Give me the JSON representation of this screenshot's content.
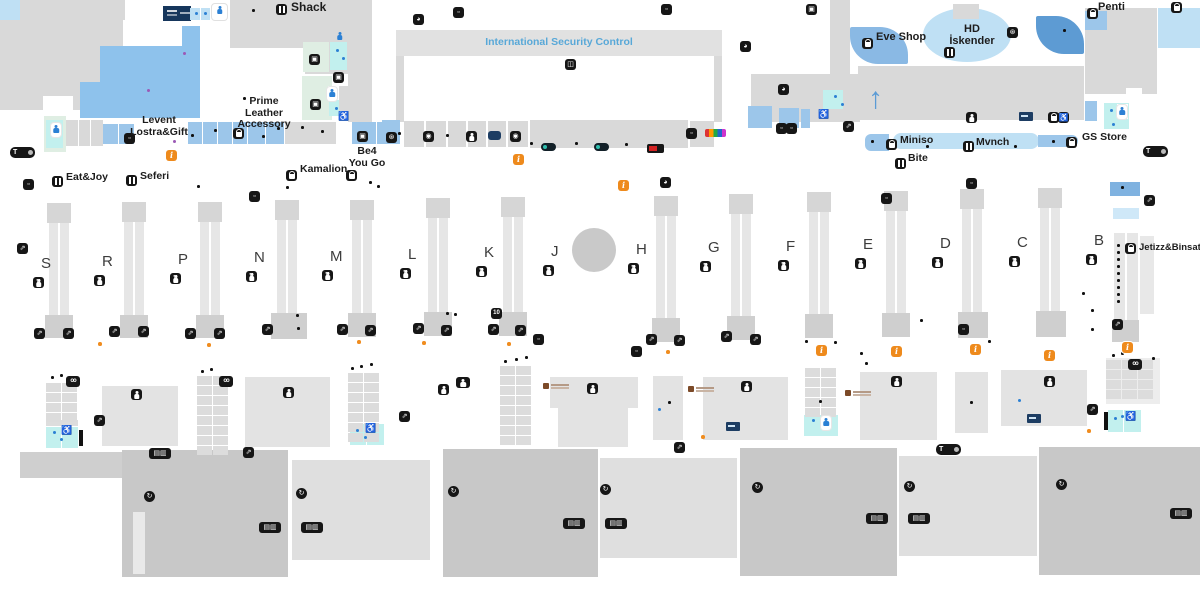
{
  "colors": {
    "accent_blue": "#58a8d8",
    "info_orange": "#ee8a1c",
    "teal_wc": "#c2f0ee",
    "navy": "#16365c",
    "map_gray": "#d9d9d9"
  },
  "labels": {
    "shack": "Shack",
    "security": "International Security Control",
    "eve_shop": "Eve Shop",
    "hd1": "HD",
    "hd2": "İskender",
    "penti": "Penti",
    "prime1": "Prime",
    "prime2": "Leather",
    "prime3": "Accessory",
    "levent1": "Levent",
    "levent2": "Lostra&Gift",
    "eat_joy": "Eat&Joy",
    "seferi": "Seferi",
    "kamalion": "Kamalion",
    "be41": "Be4",
    "be42": "You Go",
    "miniso": "Miniso",
    "mvnch": "Mvnch",
    "bite": "Bite",
    "gs_store": "GS Store",
    "jetizz": "Jetizz&Binsat"
  },
  "gates": [
    {
      "letter": "S",
      "x": 46,
      "y": 264
    },
    {
      "letter": "R",
      "x": 107,
      "y": 262
    },
    {
      "letter": "P",
      "x": 183,
      "y": 260
    },
    {
      "letter": "N",
      "x": 259,
      "y": 258
    },
    {
      "letter": "M",
      "x": 335,
      "y": 257
    },
    {
      "letter": "L",
      "x": 413,
      "y": 255
    },
    {
      "letter": "K",
      "x": 489,
      "y": 253
    },
    {
      "letter": "J",
      "x": 556,
      "y": 252
    },
    {
      "letter": "H",
      "x": 641,
      "y": 250
    },
    {
      "letter": "G",
      "x": 713,
      "y": 248
    },
    {
      "letter": "F",
      "x": 791,
      "y": 247
    },
    {
      "letter": "E",
      "x": 868,
      "y": 245
    },
    {
      "letter": "D",
      "x": 945,
      "y": 244
    },
    {
      "letter": "C",
      "x": 1022,
      "y": 243
    },
    {
      "letter": "B",
      "x": 1099,
      "y": 241
    }
  ],
  "markers": [
    {
      "t": "personbox",
      "x": 212,
      "y": 4
    },
    {
      "t": "food",
      "x": 276,
      "y": 4
    },
    {
      "t": "clock",
      "x": 413,
      "y": 14
    },
    {
      "t": "misc",
      "x": 453,
      "y": 7
    },
    {
      "t": "misc",
      "x": 661,
      "y": 4
    },
    {
      "t": "clock",
      "x": 740,
      "y": 41
    },
    {
      "t": "art",
      "x": 806,
      "y": 4
    },
    {
      "t": "clock",
      "x": 778,
      "y": 84
    },
    {
      "t": "wheel",
      "x": 1007,
      "y": 27
    },
    {
      "t": "bag",
      "x": 1087,
      "y": 8
    },
    {
      "t": "bag",
      "x": 1171,
      "y": 2
    },
    {
      "t": "bag",
      "x": 862,
      "y": 38
    },
    {
      "t": "food",
      "x": 944,
      "y": 47
    },
    {
      "t": "wc",
      "x": 966,
      "y": 112
    },
    {
      "t": "atm",
      "x": 1019,
      "y": 112
    },
    {
      "t": "bag",
      "x": 1048,
      "y": 112
    },
    {
      "t": "wheelchairk",
      "x": 1058,
      "y": 112
    },
    {
      "t": "personblue",
      "x": 1117,
      "y": 105
    },
    {
      "t": "pill",
      "x": 10,
      "y": 147
    },
    {
      "t": "pill",
      "x": 1143,
      "y": 146
    },
    {
      "t": "pill",
      "x": 936,
      "y": 444
    },
    {
      "t": "misc",
      "x": 124,
      "y": 133
    },
    {
      "t": "bag",
      "x": 233,
      "y": 128
    },
    {
      "t": "art",
      "x": 357,
      "y": 131
    },
    {
      "t": "wheel",
      "x": 386,
      "y": 132
    },
    {
      "t": "cam",
      "x": 423,
      "y": 131
    },
    {
      "t": "walk",
      "x": 466,
      "y": 131
    },
    {
      "t": "flag",
      "x": 488,
      "y": 131
    },
    {
      "t": "cam",
      "x": 510,
      "y": 131
    },
    {
      "t": "misc",
      "x": 686,
      "y": 128
    },
    {
      "t": "tealpill",
      "x": 541,
      "y": 143
    },
    {
      "t": "tealpill",
      "x": 594,
      "y": 143
    },
    {
      "t": "redpill",
      "x": 647,
      "y": 144
    },
    {
      "t": "clogo",
      "x": 705,
      "y": 129
    },
    {
      "t": "misc",
      "x": 776,
      "y": 123
    },
    {
      "t": "misc",
      "x": 786,
      "y": 123
    },
    {
      "t": "esc",
      "x": 843,
      "y": 121
    },
    {
      "t": "esc",
      "x": 1144,
      "y": 195
    },
    {
      "t": "scan",
      "x": 565,
      "y": 59
    },
    {
      "t": "info",
      "x": 166,
      "y": 150
    },
    {
      "t": "info",
      "x": 513,
      "y": 154
    },
    {
      "t": "info",
      "x": 618,
      "y": 180
    },
    {
      "t": "clock",
      "x": 660,
      "y": 177
    },
    {
      "t": "misc",
      "x": 881,
      "y": 193
    },
    {
      "t": "misc",
      "x": 966,
      "y": 178
    },
    {
      "t": "misc",
      "x": 23,
      "y": 179
    },
    {
      "t": "esc",
      "x": 17,
      "y": 243
    },
    {
      "t": "misc",
      "x": 249,
      "y": 191
    },
    {
      "t": "food",
      "x": 52,
      "y": 176
    },
    {
      "t": "food",
      "x": 126,
      "y": 175
    },
    {
      "t": "bag",
      "x": 286,
      "y": 170
    },
    {
      "t": "bag",
      "x": 346,
      "y": 170
    },
    {
      "t": "bag",
      "x": 886,
      "y": 139
    },
    {
      "t": "food",
      "x": 963,
      "y": 141
    },
    {
      "t": "food",
      "x": 895,
      "y": 158
    },
    {
      "t": "bag",
      "x": 1066,
      "y": 137
    },
    {
      "t": "bag",
      "x": 1125,
      "y": 243
    },
    {
      "t": "esc",
      "x": 34,
      "y": 328
    },
    {
      "t": "esc",
      "x": 63,
      "y": 328
    },
    {
      "t": "esc",
      "x": 109,
      "y": 326
    },
    {
      "t": "esc",
      "x": 138,
      "y": 326
    },
    {
      "t": "esc",
      "x": 185,
      "y": 328
    },
    {
      "t": "esc",
      "x": 214,
      "y": 328
    },
    {
      "t": "esc",
      "x": 262,
      "y": 324
    },
    {
      "t": "esc",
      "x": 337,
      "y": 324
    },
    {
      "t": "esc",
      "x": 365,
      "y": 325
    },
    {
      "t": "esc",
      "x": 413,
      "y": 323
    },
    {
      "t": "esc",
      "x": 441,
      "y": 325
    },
    {
      "t": "esc",
      "x": 488,
      "y": 324
    },
    {
      "t": "esc",
      "x": 515,
      "y": 325
    },
    {
      "t": "badge10",
      "x": 491,
      "y": 308
    },
    {
      "t": "misc",
      "x": 533,
      "y": 334
    },
    {
      "t": "esc",
      "x": 646,
      "y": 334
    },
    {
      "t": "esc",
      "x": 674,
      "y": 335
    },
    {
      "t": "misc",
      "x": 631,
      "y": 346
    },
    {
      "t": "esc",
      "x": 721,
      "y": 331
    },
    {
      "t": "esc",
      "x": 750,
      "y": 334
    },
    {
      "t": "info",
      "x": 816,
      "y": 345
    },
    {
      "t": "info",
      "x": 891,
      "y": 346
    },
    {
      "t": "info",
      "x": 970,
      "y": 344
    },
    {
      "t": "info",
      "x": 1044,
      "y": 350
    },
    {
      "t": "info",
      "x": 1122,
      "y": 342
    },
    {
      "t": "misc",
      "x": 958,
      "y": 324
    },
    {
      "t": "esc",
      "x": 1112,
      "y": 319
    },
    {
      "t": "co",
      "x": 66,
      "y": 376
    },
    {
      "t": "co",
      "x": 219,
      "y": 376
    },
    {
      "t": "co",
      "x": 1128,
      "y": 359
    },
    {
      "t": "wc",
      "x": 131,
      "y": 389
    },
    {
      "t": "wc",
      "x": 283,
      "y": 387
    },
    {
      "t": "wc",
      "x": 438,
      "y": 384
    },
    {
      "t": "wcf",
      "x": 456,
      "y": 377
    },
    {
      "t": "wc",
      "x": 587,
      "y": 383
    },
    {
      "t": "wc",
      "x": 741,
      "y": 381
    },
    {
      "t": "wc",
      "x": 891,
      "y": 376
    },
    {
      "t": "wc",
      "x": 1044,
      "y": 376
    },
    {
      "t": "esc",
      "x": 94,
      "y": 415
    },
    {
      "t": "esc",
      "x": 399,
      "y": 411
    },
    {
      "t": "esc",
      "x": 1087,
      "y": 404
    },
    {
      "t": "esc",
      "x": 674,
      "y": 442
    },
    {
      "t": "esc",
      "x": 243,
      "y": 447
    },
    {
      "t": "pair",
      "x": 149,
      "y": 448
    },
    {
      "t": "atm",
      "x": 726,
      "y": 422
    },
    {
      "t": "atm",
      "x": 1027,
      "y": 414
    },
    {
      "t": "brown",
      "x": 543,
      "y": 383
    },
    {
      "t": "brown",
      "x": 688,
      "y": 386
    },
    {
      "t": "brown",
      "x": 845,
      "y": 390
    },
    {
      "t": "wheelchairb",
      "x": 61,
      "y": 425
    },
    {
      "t": "wheelchairb",
      "x": 365,
      "y": 423
    },
    {
      "t": "wheelchairb",
      "x": 1125,
      "y": 411
    },
    {
      "t": "wheelchairb",
      "x": 338,
      "y": 111
    },
    {
      "t": "wheelchairb",
      "x": 818,
      "y": 109
    },
    {
      "t": "circ",
      "x": 144,
      "y": 491
    },
    {
      "t": "circ",
      "x": 296,
      "y": 488
    },
    {
      "t": "circ",
      "x": 448,
      "y": 486
    },
    {
      "t": "circ",
      "x": 600,
      "y": 484
    },
    {
      "t": "circ",
      "x": 752,
      "y": 482
    },
    {
      "t": "circ",
      "x": 904,
      "y": 481
    },
    {
      "t": "circ",
      "x": 1056,
      "y": 479
    },
    {
      "t": "pair",
      "x": 259,
      "y": 522
    },
    {
      "t": "pair",
      "x": 301,
      "y": 522
    },
    {
      "t": "pair",
      "x": 563,
      "y": 518
    },
    {
      "t": "pair",
      "x": 605,
      "y": 518
    },
    {
      "t": "pair",
      "x": 866,
      "y": 513
    },
    {
      "t": "pair",
      "x": 908,
      "y": 513
    },
    {
      "t": "pair",
      "x": 1170,
      "y": 508
    },
    {
      "t": "art",
      "x": 309,
      "y": 54
    },
    {
      "t": "art",
      "x": 333,
      "y": 72
    },
    {
      "t": "art",
      "x": 310,
      "y": 99
    },
    {
      "t": "personblue",
      "x": 327,
      "y": 87
    },
    {
      "t": "family",
      "x": 334,
      "y": 30
    },
    {
      "t": "personblue",
      "x": 821,
      "y": 416
    },
    {
      "t": "personblue",
      "x": 51,
      "y": 123
    }
  ],
  "dots": [
    {
      "x": 195,
      "y": 12,
      "c": "b"
    },
    {
      "x": 204,
      "y": 12,
      "c": "b"
    },
    {
      "x": 834,
      "y": 95,
      "c": "b"
    },
    {
      "x": 841,
      "y": 103,
      "c": "b"
    },
    {
      "x": 1110,
      "y": 109,
      "c": "b"
    },
    {
      "x": 1123,
      "y": 112,
      "c": "b"
    },
    {
      "x": 1112,
      "y": 123,
      "c": "b"
    },
    {
      "x": 336,
      "y": 49,
      "c": "b"
    },
    {
      "x": 342,
      "y": 57,
      "c": "b"
    },
    {
      "x": 335,
      "y": 107,
      "c": "b"
    },
    {
      "x": 53,
      "y": 129,
      "c": "b"
    },
    {
      "x": 812,
      "y": 419,
      "c": "b"
    },
    {
      "x": 1114,
      "y": 417,
      "c": "b"
    },
    {
      "x": 1121,
      "y": 415,
      "c": "b"
    },
    {
      "x": 53,
      "y": 431,
      "c": "b"
    },
    {
      "x": 60,
      "y": 438,
      "c": "b"
    },
    {
      "x": 356,
      "y": 429,
      "c": "b"
    },
    {
      "x": 364,
      "y": 436,
      "c": "b"
    },
    {
      "x": 1018,
      "y": 399,
      "c": "b"
    },
    {
      "x": 658,
      "y": 408,
      "c": "b"
    },
    {
      "x": 252,
      "y": 9,
      "c": "k"
    },
    {
      "x": 243,
      "y": 97,
      "c": "k"
    },
    {
      "x": 191,
      "y": 134,
      "c": "k"
    },
    {
      "x": 214,
      "y": 129,
      "c": "k"
    },
    {
      "x": 240,
      "y": 130,
      "c": "k"
    },
    {
      "x": 262,
      "y": 135,
      "c": "k"
    },
    {
      "x": 277,
      "y": 127,
      "c": "k"
    },
    {
      "x": 301,
      "y": 126,
      "c": "k"
    },
    {
      "x": 321,
      "y": 130,
      "c": "k"
    },
    {
      "x": 398,
      "y": 132,
      "c": "k"
    },
    {
      "x": 446,
      "y": 134,
      "c": "k"
    },
    {
      "x": 530,
      "y": 142,
      "c": "k"
    },
    {
      "x": 575,
      "y": 142,
      "c": "k"
    },
    {
      "x": 625,
      "y": 143,
      "c": "k"
    },
    {
      "x": 793,
      "y": 124,
      "c": "k"
    },
    {
      "x": 871,
      "y": 140,
      "c": "k"
    },
    {
      "x": 926,
      "y": 145,
      "c": "k"
    },
    {
      "x": 1014,
      "y": 145,
      "c": "k"
    },
    {
      "x": 1052,
      "y": 140,
      "c": "k"
    },
    {
      "x": 1063,
      "y": 29,
      "c": "k"
    },
    {
      "x": 1121,
      "y": 186,
      "c": "k"
    },
    {
      "x": 197,
      "y": 185,
      "c": "k"
    },
    {
      "x": 286,
      "y": 186,
      "c": "k"
    },
    {
      "x": 369,
      "y": 181,
      "c": "k"
    },
    {
      "x": 377,
      "y": 185,
      "c": "k"
    },
    {
      "x": 296,
      "y": 314,
      "c": "k"
    },
    {
      "x": 297,
      "y": 327,
      "c": "k"
    },
    {
      "x": 446,
      "y": 312,
      "c": "k"
    },
    {
      "x": 454,
      "y": 313,
      "c": "k"
    },
    {
      "x": 805,
      "y": 340,
      "c": "k"
    },
    {
      "x": 834,
      "y": 341,
      "c": "k"
    },
    {
      "x": 920,
      "y": 319,
      "c": "k"
    },
    {
      "x": 988,
      "y": 340,
      "c": "k"
    },
    {
      "x": 1091,
      "y": 309,
      "c": "k"
    },
    {
      "x": 1091,
      "y": 328,
      "c": "k"
    },
    {
      "x": 1082,
      "y": 292,
      "c": "k"
    },
    {
      "x": 51,
      "y": 376,
      "c": "k"
    },
    {
      "x": 60,
      "y": 374,
      "c": "k"
    },
    {
      "x": 201,
      "y": 370,
      "c": "k"
    },
    {
      "x": 210,
      "y": 368,
      "c": "k"
    },
    {
      "x": 351,
      "y": 367,
      "c": "k"
    },
    {
      "x": 360,
      "y": 365,
      "c": "k"
    },
    {
      "x": 370,
      "y": 363,
      "c": "k"
    },
    {
      "x": 504,
      "y": 360,
      "c": "k"
    },
    {
      "x": 515,
      "y": 358,
      "c": "k"
    },
    {
      "x": 525,
      "y": 356,
      "c": "k"
    },
    {
      "x": 860,
      "y": 352,
      "c": "k"
    },
    {
      "x": 865,
      "y": 362,
      "c": "k"
    },
    {
      "x": 1152,
      "y": 357,
      "c": "k"
    },
    {
      "x": 1112,
      "y": 354,
      "c": "k"
    },
    {
      "x": 1121,
      "y": 352,
      "c": "k"
    },
    {
      "x": 1130,
      "y": 350,
      "c": "k"
    },
    {
      "x": 819,
      "y": 400,
      "c": "k"
    },
    {
      "x": 970,
      "y": 401,
      "c": "k"
    },
    {
      "x": 668,
      "y": 401,
      "c": "k"
    },
    {
      "x": 1117,
      "y": 244,
      "c": "k"
    },
    {
      "x": 1117,
      "y": 251,
      "c": "k"
    },
    {
      "x": 1117,
      "y": 258,
      "c": "k"
    },
    {
      "x": 1117,
      "y": 265,
      "c": "k"
    },
    {
      "x": 1117,
      "y": 272,
      "c": "k"
    },
    {
      "x": 1117,
      "y": 279,
      "c": "k"
    },
    {
      "x": 1117,
      "y": 286,
      "c": "k"
    },
    {
      "x": 1117,
      "y": 293,
      "c": "k"
    },
    {
      "x": 1117,
      "y": 300,
      "c": "k"
    },
    {
      "x": 98,
      "y": 342,
      "c": "o"
    },
    {
      "x": 207,
      "y": 343,
      "c": "o"
    },
    {
      "x": 357,
      "y": 340,
      "c": "o"
    },
    {
      "x": 422,
      "y": 341,
      "c": "o"
    },
    {
      "x": 507,
      "y": 342,
      "c": "o"
    },
    {
      "x": 666,
      "y": 350,
      "c": "o"
    },
    {
      "x": 701,
      "y": 435,
      "c": "o"
    },
    {
      "x": 1087,
      "y": 429,
      "c": "o"
    },
    {
      "x": 147,
      "y": 89,
      "c": "p"
    },
    {
      "x": 183,
      "y": 52,
      "c": "p"
    },
    {
      "x": 173,
      "y": 140,
      "c": "p"
    }
  ],
  "desks": [
    {
      "x": 46,
      "y": 383,
      "cols": 2,
      "rows": 4
    },
    {
      "x": 197,
      "y": 376,
      "cols": 2,
      "rows": 8
    },
    {
      "x": 348,
      "y": 373,
      "cols": 2,
      "rows": 7
    },
    {
      "x": 500,
      "y": 366,
      "cols": 2,
      "rows": 8
    },
    {
      "x": 805,
      "y": 368,
      "cols": 2,
      "rows": 5
    },
    {
      "x": 1106,
      "y": 360,
      "cols": 3,
      "rows": 4
    }
  ]
}
